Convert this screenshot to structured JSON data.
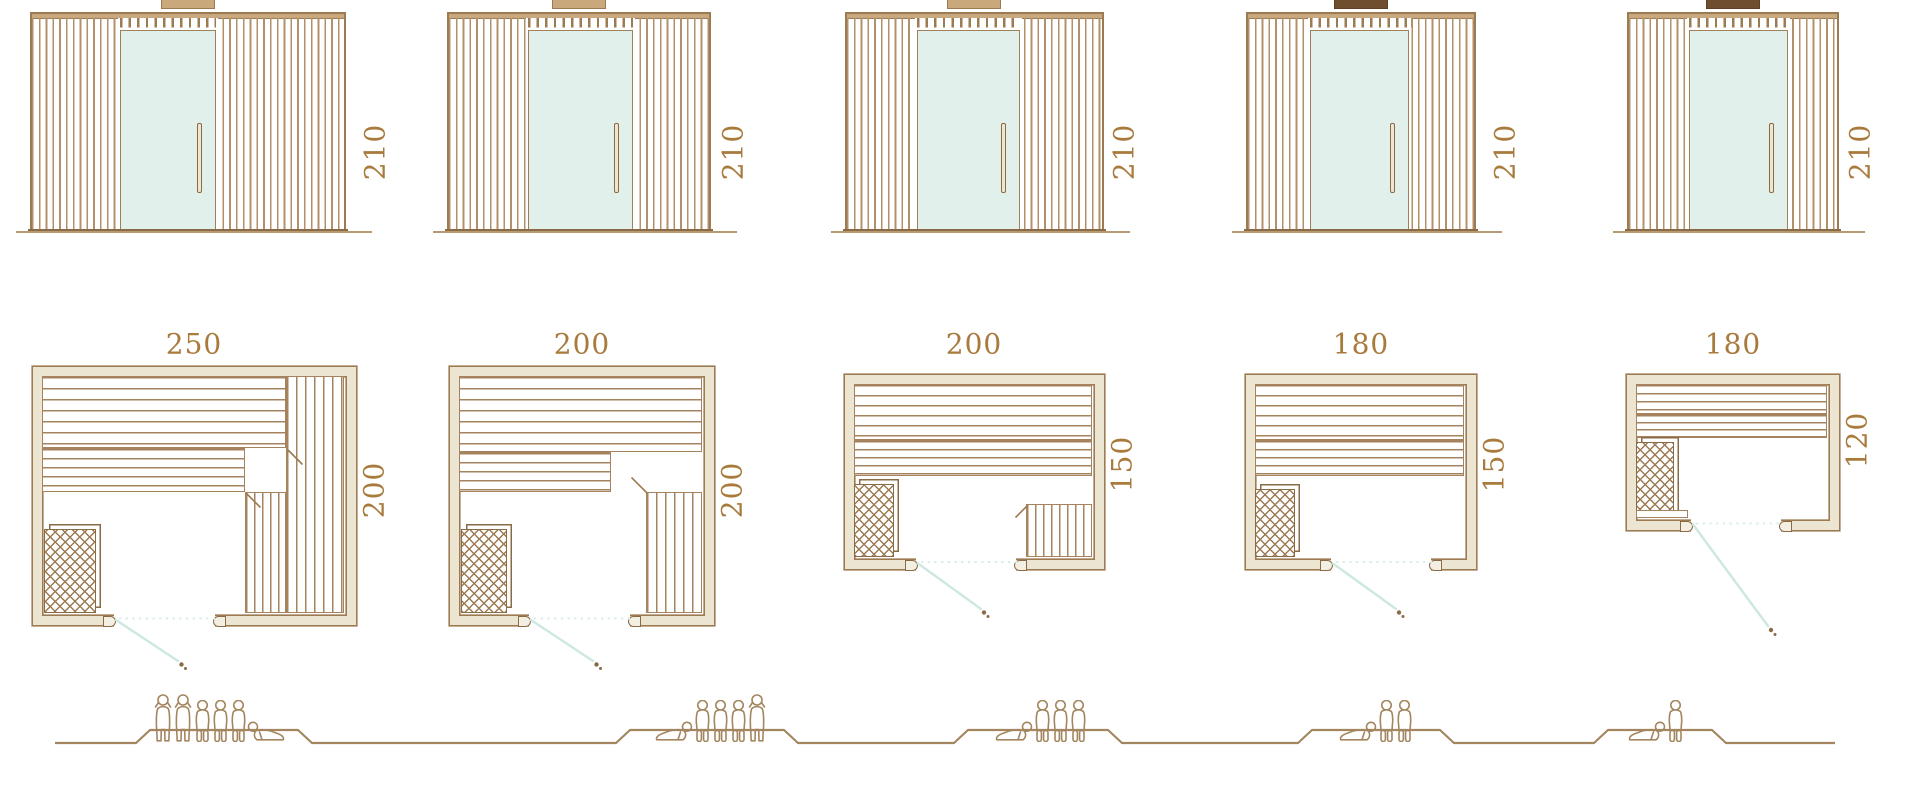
{
  "colors": {
    "outline": "#9c7a52",
    "slat_line": "#a5835f",
    "wall_fill": "#ece5d1",
    "glass": "#e2f0eb",
    "door_swing": "#cde8e0",
    "dimension_text": "#a87a3c",
    "figure_outline": "#a3865f",
    "dark_vent_block": "#6e4e2e"
  },
  "models": [
    {
      "elevation": {
        "height_label": "210"
      },
      "plan": {
        "width_label": "250",
        "depth_label": "200"
      },
      "capacity": {
        "count": 6,
        "sequence": [
          "standing",
          "standing",
          "sitting",
          "sitting",
          "sitting",
          "reclining"
        ]
      }
    },
    {
      "elevation": {
        "height_label": "210"
      },
      "plan": {
        "width_label": "200",
        "depth_label": "200"
      },
      "capacity": {
        "count": 5,
        "sequence": [
          "reclining",
          "sitting",
          "sitting",
          "sitting",
          "standing"
        ]
      }
    },
    {
      "elevation": {
        "height_label": "210"
      },
      "plan": {
        "width_label": "200",
        "depth_label": "150"
      },
      "capacity": {
        "count": 4,
        "sequence": [
          "reclining",
          "sitting",
          "sitting",
          "sitting"
        ]
      }
    },
    {
      "elevation": {
        "height_label": "210"
      },
      "plan": {
        "width_label": "180",
        "depth_label": "150"
      },
      "capacity": {
        "count": 3,
        "sequence": [
          "reclining",
          "sitting",
          "sitting"
        ]
      }
    },
    {
      "elevation": {
        "height_label": "210"
      },
      "plan": {
        "width_label": "180",
        "depth_label": "120"
      },
      "capacity": {
        "count": 2,
        "sequence": [
          "reclining",
          "sitting"
        ]
      }
    }
  ]
}
